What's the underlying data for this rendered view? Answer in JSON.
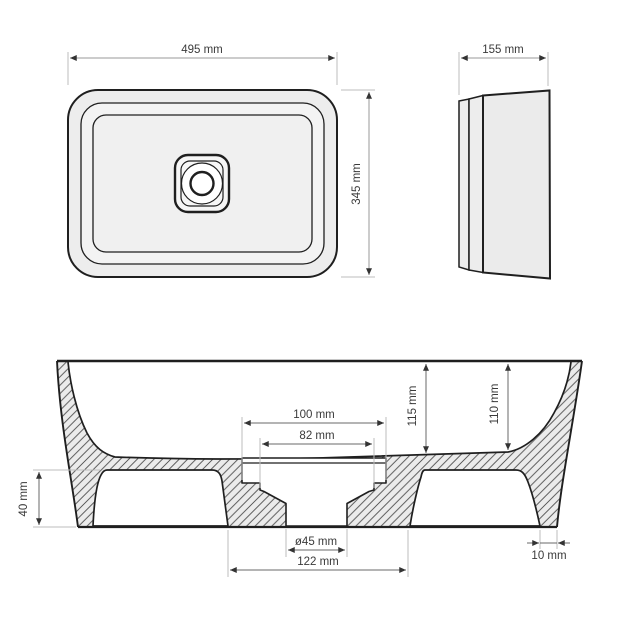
{
  "drawing": {
    "type": "washbasin-technical-dimension-drawing",
    "unit": "mm",
    "top_view": {
      "width_label": "495 mm",
      "depth_label": "345 mm"
    },
    "side_view": {
      "width_label": "155 mm"
    },
    "section_view": {
      "recess_width_label": "100 mm",
      "recess_inner_width_label": "82 mm",
      "bowl_depth_center_label": "115 mm",
      "bowl_depth_right_label": "110 mm",
      "base_height_label": "40 mm",
      "drain_diameter_label": "ø45 mm",
      "base_width_label": "122 mm",
      "wall_foot_label": "10 mm"
    },
    "colors": {
      "line": "#1f1f1f",
      "material_fill": "#ebebeb",
      "hatch_line": "#4d4d4d",
      "dimension_line": "#6a6a6a",
      "extension_line": "#bcbcbc",
      "text": "#3a3a3a",
      "background": "#ffffff"
    }
  }
}
